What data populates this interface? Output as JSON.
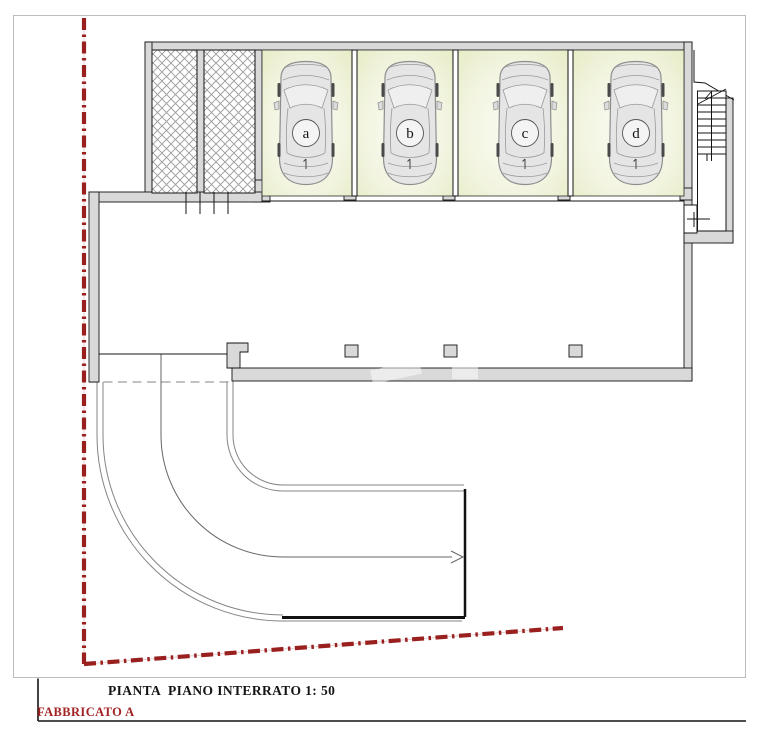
{
  "title_block": {
    "drawing_title": "PIANTA  PIANO INTERRATO 1: 50",
    "building_label": "FABBRICATO A"
  },
  "plan": {
    "garages": [
      {
        "label": "a"
      },
      {
        "label": "b"
      },
      {
        "label": "c"
      },
      {
        "label": "d"
      }
    ],
    "storage_rooms_count": 2,
    "parking_spaces_count": 4
  },
  "icons": {
    "car": "car-top-view-icon",
    "stairs": "staircase-icon",
    "ramp_arrow": "right-arrow-icon",
    "door_marker": "cross-marker-icon"
  },
  "colors": {
    "boundary_red": "#9a2020",
    "building_label_red": "#a32424",
    "wall_fill": "#d9d9d9",
    "garage_floor_green": "#e9eecb",
    "hatch_line_gray": "#9a9a9a",
    "drawing_line": "#141414"
  }
}
